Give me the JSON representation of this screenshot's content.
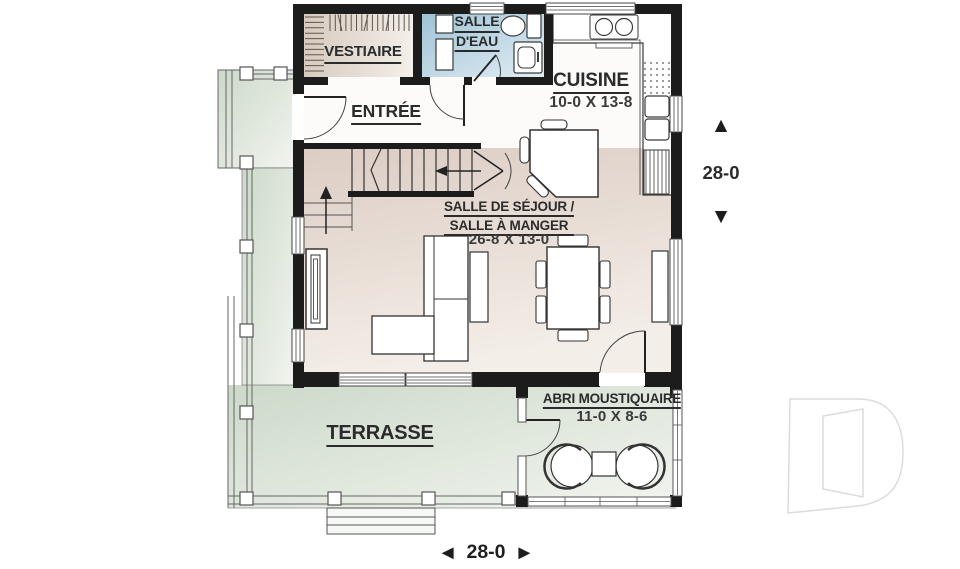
{
  "rooms": {
    "vestiaire": {
      "label": "VESTIAIRE"
    },
    "salle_deau": {
      "label_line1": "SALLE",
      "label_line2": "D'EAU"
    },
    "entree": {
      "label": "ENTRÉE"
    },
    "cuisine": {
      "label": "CUISINE",
      "size": "10-0 X 13-8"
    },
    "sejour": {
      "label_line1": "SALLE DE SÉJOUR /",
      "label_line2": "SALLE À MANGER",
      "size": "26-8 X 13-0"
    },
    "terrasse": {
      "label": "TERRASSE"
    },
    "abri_moustiquaire": {
      "label": "ABRI MOUSTIQUAIRE",
      "size": "11-0 X 8-6"
    }
  },
  "dimensions": {
    "vertical": {
      "value": "28-0",
      "arrow_up": "▲",
      "arrow_down": "▼"
    },
    "horizontal": {
      "value": "28-0",
      "arrow_left": "◄",
      "arrow_right": "►"
    }
  },
  "watermark": {
    "letter": "D"
  },
  "colors": {
    "wall": "#1c1c1c",
    "label_text": "#2b2b2b",
    "dim_text": "#3a3a3a",
    "interior_floor_beige": "#dccdc4",
    "bathroom_blue": "#a0c3d6",
    "porch_green": "#ccd9c9",
    "closet_tan": "#d6cabe",
    "watermark_gray": "#dcdcdc"
  }
}
